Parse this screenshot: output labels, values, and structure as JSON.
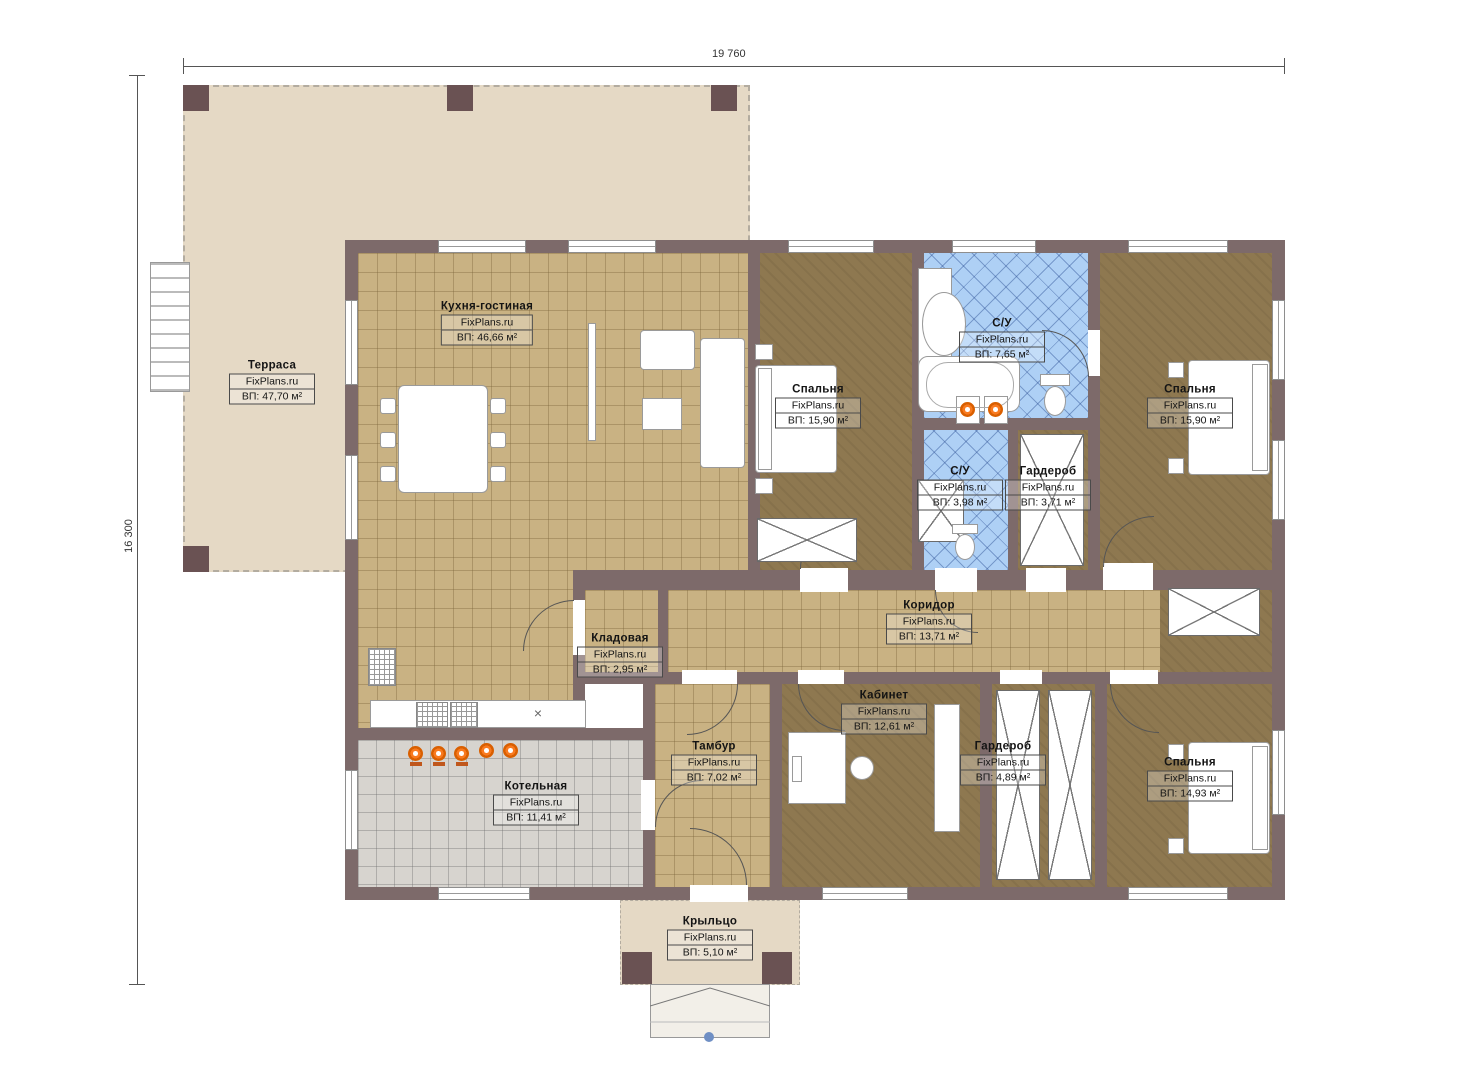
{
  "brand": "FixPlans.ru",
  "dimensions": {
    "width_label": "19 760",
    "height_label": "16 300"
  },
  "rooms": {
    "terrace": {
      "name": "Терраса",
      "brand": "FixPlans.ru",
      "area": "ВП: 47,70 м²"
    },
    "kitchen": {
      "name": "Кухня-гостиная",
      "brand": "FixPlans.ru",
      "area": "ВП: 46,66 м²"
    },
    "bedroom1": {
      "name": "Спальня",
      "brand": "FixPlans.ru",
      "area": "ВП: 15,90 м²"
    },
    "bath1": {
      "name": "С/У",
      "brand": "FixPlans.ru",
      "area": "ВП: 7,65 м²"
    },
    "bath2": {
      "name": "С/У",
      "brand": "FixPlans.ru",
      "area": "ВП: 3,98 м²"
    },
    "wardrobe1": {
      "name": "Гардероб",
      "brand": "FixPlans.ru",
      "area": "ВП: 3,71 м²"
    },
    "bedroom2": {
      "name": "Спальня",
      "brand": "FixPlans.ru",
      "area": "ВП: 15,90 м²"
    },
    "corridor": {
      "name": "Коридор",
      "brand": "FixPlans.ru",
      "area": "ВП: 13,71 м²"
    },
    "pantry": {
      "name": "Кладовая",
      "brand": "FixPlans.ru",
      "area": "ВП: 2,95 м²"
    },
    "vestibule": {
      "name": "Тамбур",
      "brand": "FixPlans.ru",
      "area": "ВП: 7,02 м²"
    },
    "office": {
      "name": "Кабинет",
      "brand": "FixPlans.ru",
      "area": "ВП: 12,61 м²"
    },
    "wardrobe2": {
      "name": "Гардероб",
      "brand": "FixPlans.ru",
      "area": "ВП: 4,89 м²"
    },
    "bedroom3": {
      "name": "Спальня",
      "brand": "FixPlans.ru",
      "area": "ВП: 14,93 м²"
    },
    "boiler": {
      "name": "Котельная",
      "brand": "FixPlans.ru",
      "area": "ВП: 11,41 м²"
    },
    "porch": {
      "name": "Крыльцо",
      "brand": "FixPlans.ru",
      "area": "ВП: 5,10 м²"
    }
  },
  "misc": {
    "sink_mark": "×"
  },
  "colors": {
    "wall": "#7d6a6a",
    "floor_tan": "#c9b283",
    "floor_brown": "#8e7850",
    "tile_blue": "#aed0f5",
    "tile_gray": "#d7d4cf",
    "terrace": "#e5d9c5",
    "accent_orange": "#f97a1f"
  }
}
